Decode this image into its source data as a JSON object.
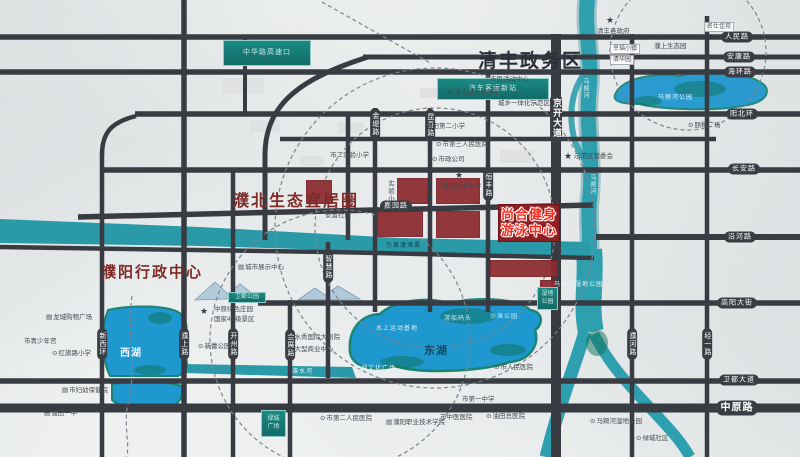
{
  "districts": {
    "qingfeng": "清丰政务区",
    "pubei": "濮北生态宜居圈",
    "admin": "濮阳行政中心"
  },
  "project": {
    "line1": "尚合健身",
    "line2": "游泳中心"
  },
  "teal_boxes": [
    {
      "x": 223,
      "y": 40,
      "w": 88,
      "h": 26,
      "small": false,
      "lines": [
        "中华路高速口"
      ]
    },
    {
      "x": 437,
      "y": 78,
      "w": 112,
      "h": 22,
      "small": false,
      "lines": [
        "汽车客运新站"
      ]
    },
    {
      "x": 228,
      "y": 292,
      "w": 38,
      "h": 11,
      "small": true,
      "lines": [
        "卫都公园"
      ]
    },
    {
      "x": 261,
      "y": 410,
      "w": 25,
      "h": 27,
      "small": true,
      "lines": [
        "绿城",
        "广场"
      ]
    },
    {
      "x": 537,
      "y": 287,
      "w": 21,
      "h": 23,
      "small": true,
      "lines": [
        "湿地",
        "公园"
      ]
    }
  ],
  "road_labels_h": [
    {
      "x": 737,
      "y": 37,
      "t": "人民路"
    },
    {
      "x": 739,
      "y": 57,
      "t": "安康路"
    },
    {
      "x": 740,
      "y": 72,
      "t": "海环路"
    },
    {
      "x": 742,
      "y": 114,
      "t": "阳北环"
    },
    {
      "x": 744,
      "y": 169,
      "t": "长安路"
    },
    {
      "x": 740,
      "y": 237,
      "t": "沿河路"
    },
    {
      "x": 737,
      "y": 303,
      "t": "高阳大街"
    },
    {
      "x": 739,
      "y": 380,
      "t": "卫都大道"
    },
    {
      "x": 737,
      "y": 408,
      "t": "中原路",
      "size": 10,
      "bold": true
    },
    {
      "x": 396,
      "y": 206,
      "t": "嘉园路"
    }
  ],
  "road_labels_v": [
    {
      "x": 556,
      "y": 118,
      "t": "京开大道",
      "size": 9,
      "bold": true
    },
    {
      "x": 375,
      "y": 124,
      "t": "金堤路"
    },
    {
      "x": 430,
      "y": 125,
      "t": "昆吾路"
    },
    {
      "x": 488,
      "y": 185,
      "t": "恒丰路"
    },
    {
      "x": 328,
      "y": 267,
      "t": "智慧路"
    },
    {
      "x": 102,
      "y": 344,
      "t": "新西环"
    },
    {
      "x": 184,
      "y": 344,
      "t": "濮上路"
    },
    {
      "x": 233,
      "y": 344,
      "t": "开州路"
    },
    {
      "x": 290,
      "y": 345,
      "t": "会展路"
    },
    {
      "x": 632,
      "y": 344,
      "t": "濮河路"
    },
    {
      "x": 707,
      "y": 344,
      "t": "经一路"
    }
  ],
  "water_labels": [
    {
      "x": 120,
      "y": 344,
      "t": "西湖",
      "size": 10,
      "bold": true,
      "color": "#eaf6fb"
    },
    {
      "x": 424,
      "y": 342,
      "t": "东湖",
      "size": 11,
      "bold": true,
      "color": "#0d4a66"
    },
    {
      "x": 658,
      "y": 92,
      "t": "马颊河公园",
      "size": 6,
      "color": "#e8f6fb"
    },
    {
      "x": 581,
      "y": 78,
      "t": "马颊河",
      "size": 6,
      "color": "#dff2f6",
      "vertical": true
    },
    {
      "x": 588,
      "y": 174,
      "t": "马颊河",
      "size": 6,
      "color": "#dff2f6",
      "vertical": true
    },
    {
      "x": 386,
      "y": 240,
      "t": "引黄灌溉渠",
      "size": 6,
      "color": "#113f4a"
    },
    {
      "x": 554,
      "y": 279,
      "t": "马颊河湿地公园",
      "size": 6,
      "color": "#e8f6fb"
    },
    {
      "x": 376,
      "y": 323,
      "t": "水上运动基地",
      "size": 6,
      "color": "#dff2f8"
    },
    {
      "x": 444,
      "y": 313,
      "t": "游船码头",
      "size": 6,
      "color": "#cfeaf4"
    },
    {
      "x": 490,
      "y": 311,
      "t": "沙滩公园",
      "size": 6,
      "color": "#cfeaf4"
    },
    {
      "x": 354,
      "y": 363,
      "t": "东湖文化广场",
      "size": 6,
      "color": "#dff2f8"
    },
    {
      "x": 292,
      "y": 366,
      "t": "濮水河",
      "size": 6,
      "color": "#dff2f8"
    }
  ],
  "pois": [
    {
      "x": 564,
      "y": 152,
      "t": "",
      "icon": "star"
    },
    {
      "x": 574,
      "y": 154,
      "t": "示范区管委会",
      "icon": ""
    },
    {
      "x": 606,
      "y": 16,
      "t": "",
      "icon": "star"
    },
    {
      "x": 597,
      "y": 29,
      "t": "清丰县政府",
      "icon": ""
    },
    {
      "x": 455,
      "y": 171,
      "t": "",
      "icon": "star"
    },
    {
      "x": 442,
      "y": 184,
      "t": "油田艺术中学",
      "icon": ""
    },
    {
      "x": 200,
      "y": 307,
      "t": "",
      "icon": "star"
    },
    {
      "x": 214,
      "y": 307,
      "t": "中原绿色庄园",
      "icon": ""
    },
    {
      "x": 214,
      "y": 317,
      "t": "国家4A级景区",
      "icon": ""
    },
    {
      "x": 448,
      "y": 90,
      "t": "清丰县实验小学",
      "icon": "dot"
    },
    {
      "x": 498,
      "y": 101,
      "t": "城乡一体化示范区",
      "icon": ""
    },
    {
      "x": 426,
      "y": 124,
      "t": "油田第二小学",
      "icon": ""
    },
    {
      "x": 436,
      "y": 142,
      "t": "市第三人民医院",
      "icon": "dot"
    },
    {
      "x": 330,
      "y": 153,
      "t": "市二实验小学",
      "icon": ""
    },
    {
      "x": 432,
      "y": 157,
      "t": "市政公司",
      "icon": "dot"
    },
    {
      "x": 490,
      "y": 77,
      "t": "市民活动中心",
      "icon": ""
    },
    {
      "x": 654,
      "y": 44,
      "t": "濮上生态园",
      "icon": ""
    },
    {
      "x": 688,
      "y": 123,
      "t": "颐和广场",
      "icon": "dot"
    },
    {
      "x": 238,
      "y": 265,
      "t": "城市展示中心",
      "icon": "bld"
    },
    {
      "x": 198,
      "y": 344,
      "t": "新蕾公园",
      "icon": "dot"
    },
    {
      "x": 46,
      "y": 315,
      "t": "龙城购物广场",
      "icon": "bld"
    },
    {
      "x": 24,
      "y": 339,
      "t": "市青少年宫",
      "icon": ""
    },
    {
      "x": 52,
      "y": 351,
      "t": "红旗路小学",
      "icon": "dot"
    },
    {
      "x": 62,
      "y": 388,
      "t": "市妇幼保健院",
      "icon": "bld"
    },
    {
      "x": 288,
      "y": 335,
      "t": "水秀国际大剧院",
      "icon": "dot"
    },
    {
      "x": 288,
      "y": 347,
      "t": "大型商业中心",
      "icon": "dot"
    },
    {
      "x": 494,
      "y": 365,
      "t": "市人民医院",
      "icon": "dot"
    },
    {
      "x": 462,
      "y": 397,
      "t": "市第一中学",
      "icon": ""
    },
    {
      "x": 320,
      "y": 416,
      "t": "市第二人民医院",
      "icon": "dot"
    },
    {
      "x": 386,
      "y": 420,
      "t": "濮阳职业技术学院",
      "icon": "bld"
    },
    {
      "x": 440,
      "y": 415,
      "t": "市中医医院",
      "icon": ""
    },
    {
      "x": 486,
      "y": 414,
      "t": "油田总医院",
      "icon": "dot"
    },
    {
      "x": 590,
      "y": 419,
      "t": "马颊河湿地公园",
      "icon": "dot"
    },
    {
      "x": 636,
      "y": 436,
      "t": "绿城社区",
      "icon": "dot"
    },
    {
      "x": 44,
      "y": 411,
      "t": "油田一中",
      "icon": "bld"
    },
    {
      "x": 325,
      "y": 213,
      "t": "安置社区",
      "icon": ""
    },
    {
      "x": 386,
      "y": 180,
      "t": "实验小学",
      "icon": "",
      "vertical": true
    }
  ],
  "chips": [
    {
      "x": 610,
      "y": 44,
      "t": "幸福小镇"
    },
    {
      "x": 610,
      "y": 55,
      "t": "清华园"
    },
    {
      "x": 704,
      "y": 22,
      "t": "名仕佳苑"
    }
  ],
  "colors": {
    "road": "#383c42",
    "river": "#2e9fae",
    "lake": "#1f97cf",
    "lake_fringe": "#1b8573",
    "red_block": "#8c2a2e",
    "project_text": "#ff2a1a",
    "teal_box": "#17807c",
    "district_red": "#7e2b28",
    "district_navy": "#2a3038"
  },
  "red_blocks": [
    [
      397,
      178,
      31,
      26
    ],
    [
      436,
      178,
      44,
      26
    ],
    [
      306,
      180,
      26,
      24
    ],
    [
      377,
      211,
      46,
      26
    ],
    [
      436,
      211,
      44,
      27
    ],
    [
      490,
      260,
      68,
      17
    ],
    [
      540,
      280,
      16,
      8
    ]
  ]
}
